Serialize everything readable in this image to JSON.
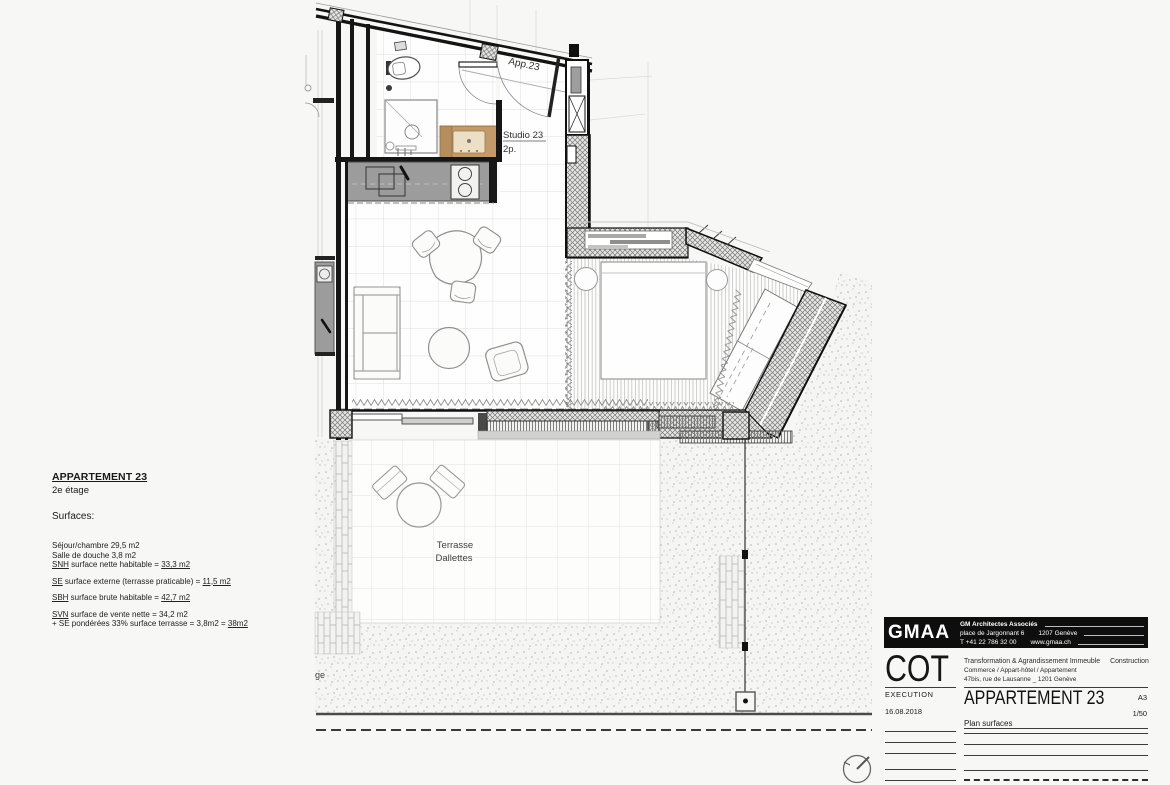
{
  "canvas": {
    "bg": "#f7f7f5",
    "ink": "#1a1a1a",
    "counter_gray": "#9c9c9c",
    "cabinet_tan": "#c49a6b",
    "paper": "#fdfdfc"
  },
  "notes": {
    "title": "APPARTEMENT 23",
    "floor": "2e étage",
    "section": "Surfaces:",
    "lines": [
      {
        "label": "",
        "text": "Séjour/chambre 29,5 m2",
        "value": ""
      },
      {
        "label": "",
        "text": "Salle de douche 3,8 m2",
        "value": ""
      },
      {
        "label": "SNH",
        "text": " surface nette habitable = ",
        "value": "33,3 m2"
      },
      {
        "label": "SE",
        "text": " surface externe (terrasse praticable) = ",
        "value": "11,5 m2"
      },
      {
        "label": "SBH",
        "text": " surface brute habitable = ",
        "value": "42,7 m2"
      },
      {
        "label": "SVN",
        "text": " surface de vente nette = 34,2 m2",
        "value": ""
      },
      {
        "label": "",
        "text": "+ SE pondérées 33% surface terrasse = 3,8m2 = ",
        "value": "38m2"
      }
    ]
  },
  "plan_labels": {
    "entry": "App.23",
    "unit": "Studio 23",
    "unit_sub": "2p.",
    "terrace_1": "Terrasse",
    "terrace_2": "Dallettes",
    "edge_fragment": "ge"
  },
  "title_block": {
    "logo": "GMAA",
    "firm": "GM Architectes Associés",
    "street": "place de Jargonnant 6",
    "city": "1207 Genève",
    "phone": "T +41 22 786 32 00",
    "web": "www.gmaa.ch",
    "code": "COT",
    "project_line1a": "Transformation & Agrandissement Immeuble",
    "project_line1b": "Construction",
    "project_line2": "Commerce / Appart-hôtel / Appartement",
    "project_line3": "47bis, rue de Lausanne _ 1201 Genève",
    "phase": "EXECUTION",
    "date": "16.08.2018",
    "sheet_title": "APPARTEMENT 23",
    "format": "A3",
    "scale": "1/50",
    "drawing_name": "Plan surfaces"
  }
}
